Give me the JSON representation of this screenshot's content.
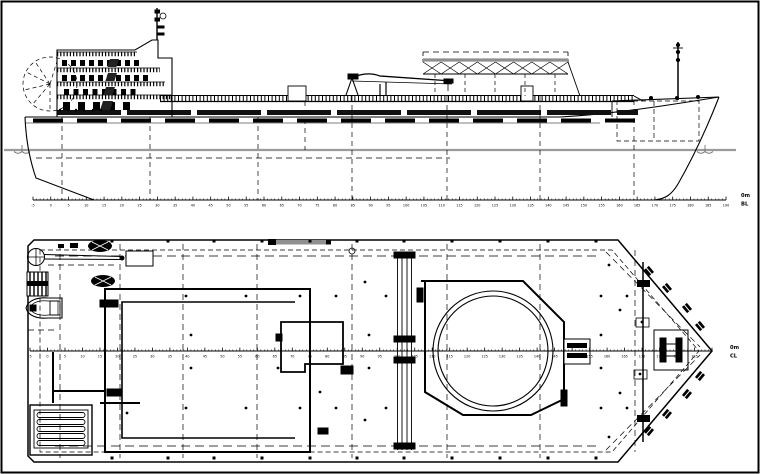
{
  "drawing_title": "cargo ship general arrangement - side profile and main deck plan",
  "colors": {
    "ink": "#000000",
    "background": "#ffffff",
    "waterline_gray": "#9b9b9b",
    "structure_gray": "#8f8f8f"
  },
  "labels": {
    "profile_datum_top": "0m",
    "profile_datum_bottom": "BL",
    "plan_datum_top": "0m",
    "plan_datum_bottom": "CL"
  },
  "profile_scale": {
    "y": 200,
    "x0": 33,
    "x1": 726,
    "start": -5,
    "end": 190,
    "label_step": 5,
    "minor_step": 1,
    "label_end": 190
  },
  "plan_scale": {
    "y": 351,
    "x0": 30,
    "x1": 712,
    "start": -5,
    "end": 190,
    "label_step": 5,
    "minor_step": 1,
    "label_end": 185
  },
  "superstructure": {
    "window_rows": [
      {
        "y": 60,
        "x0": 62,
        "count": 9,
        "step": 9,
        "w": 5,
        "h": 6
      },
      {
        "y": 75,
        "x0": 62,
        "count": 10,
        "step": 9,
        "w": 5,
        "h": 6
      },
      {
        "y": 89,
        "x0": 64,
        "count": 8,
        "step": 9.5,
        "w": 5,
        "h": 6
      },
      {
        "y": 102,
        "x0": 63,
        "count": 5,
        "step": 15,
        "w": 7,
        "h": 8
      }
    ]
  },
  "gantry": {
    "bays": 8,
    "x0": 423,
    "x1": 568,
    "top": 62,
    "bottom": 74
  },
  "plan": {
    "deck_fittings": {
      "dot_rows": [
        {
          "y": 296,
          "xs": [
            186,
            246,
            300,
            336,
            386,
            601,
            627
          ]
        },
        {
          "y": 408,
          "xs": [
            186,
            246,
            300,
            336,
            386,
            601,
            627
          ]
        },
        {
          "y": 335,
          "xs": [
            191,
            278,
            369,
            601
          ]
        },
        {
          "y": 368,
          "xs": [
            191,
            278,
            369,
            601
          ]
        }
      ],
      "extra_dots": [
        [
          127,
          413
        ],
        [
          320,
          392
        ],
        [
          365,
          282
        ],
        [
          365,
          420
        ],
        [
          609,
          265
        ],
        [
          609,
          437
        ],
        [
          620,
          310
        ],
        [
          620,
          393
        ]
      ],
      "edge_square_rows": [
        {
          "y": 241,
          "xs": [
            112,
            168,
            214,
            262,
            310,
            357,
            404,
            452,
            500,
            548,
            596
          ]
        },
        {
          "y": 458,
          "xs": [
            112,
            168,
            214,
            262,
            310,
            357,
            404,
            452,
            500,
            548,
            596
          ]
        }
      ],
      "bollard_pairs_top": [
        [
          649,
          271
        ],
        [
          667,
          288
        ],
        [
          687,
          308
        ],
        [
          700,
          326
        ]
      ],
      "bollard_pairs_bottom": [
        [
          649,
          431
        ],
        [
          667,
          414
        ],
        [
          687,
          394
        ],
        [
          700,
          376
        ]
      ]
    }
  }
}
